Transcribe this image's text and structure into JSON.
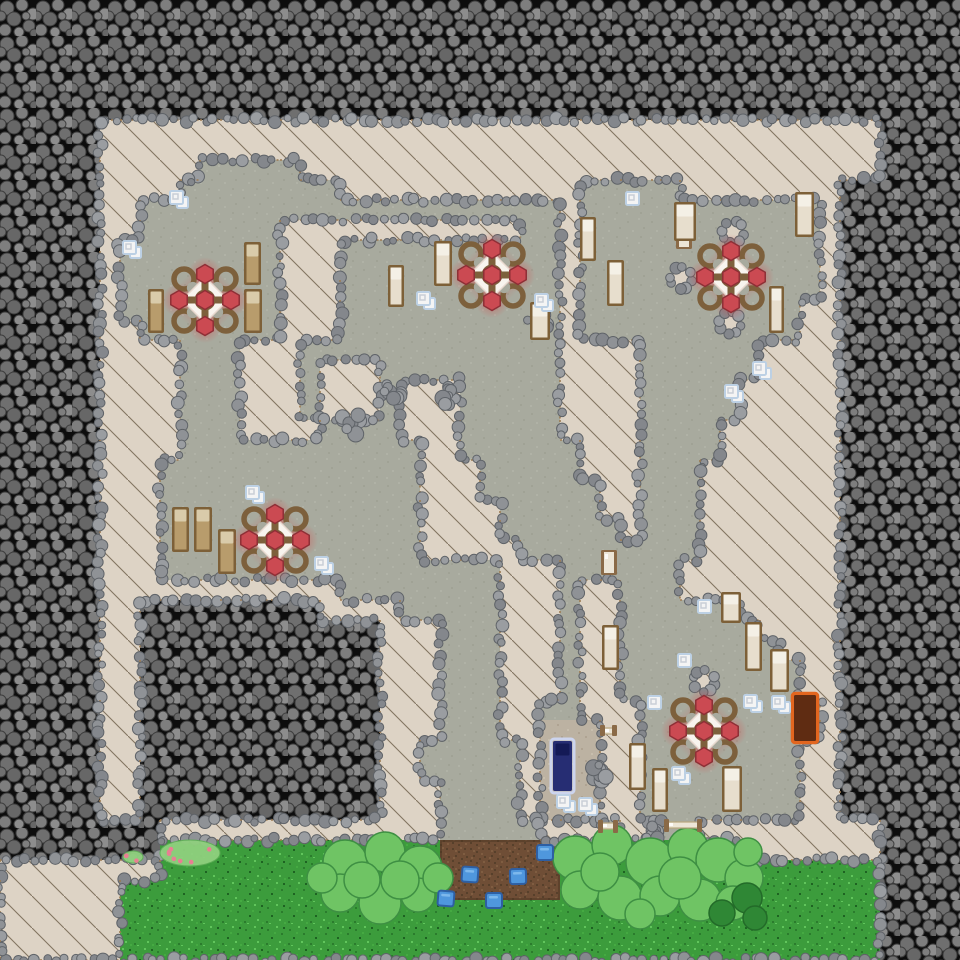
{
  "meta": {
    "width": 960,
    "height": 960,
    "tile_size": 20
  },
  "palette": {
    "rock_bg": "#0d0d0d",
    "boulder_fills": [
      "#6f6f6f",
      "#7e7e7e",
      "#8d8d8d",
      "#676767"
    ],
    "boulder_stroke": "#3d3d3d",
    "wall": "#ddd3c5",
    "wall_hatch": "#64543f",
    "wall_edge": "#9c7b52",
    "floor": "#a8aa9e",
    "floor_specks": [
      "#9da092",
      "#b2b4a7"
    ],
    "floor_light": "#bcb2a2",
    "floor_light_specks": [
      "#ab9f8e",
      "#c9c0b0"
    ],
    "grass": "#3c9c3c",
    "grass_speckles": [
      "#2b7c2d",
      "#61c55c",
      "#1e6322",
      "#45aa42"
    ],
    "dirt": "#6f4e36",
    "dirt_dots": [
      "#57402b",
      "#7f5d41"
    ],
    "dirt_edge": "#4e3723",
    "border_boulder": [
      "#8f9296",
      "#9a9da1",
      "#84878c"
    ],
    "border_boulder_stroke": "#5f6368",
    "glow_red": "#d64545",
    "table_wood": "#7d603c",
    "table_plate": "#f8f4ee",
    "table_plate_edge": "#e8d9cf",
    "table_food": "#cb4a52",
    "table_food_stroke": "#8e2f36",
    "bed_frame": "#7d6038",
    "bed_fill_light": "#e7decd",
    "bed_pillow_light": "#f4f0e6",
    "bed_fill_dark": "#b89c6c",
    "bed_pillow_dark": "#d9cbaa",
    "bed_blue_halo": "#cdd7f6",
    "bed_blue_fill": "#262d73",
    "bed_blue_dark": "#141a56",
    "bed_orange_halo": "#e2661f",
    "bed_orange_fill": "#5f2c12",
    "item_fill": "#f4f4f4",
    "item_stroke": "#bcd0e4",
    "door_wood": "#8a6a47",
    "door_panel": "#ece5d6",
    "bush_fill": "#6fc464",
    "bush_stroke": "#3e8f43",
    "bush_dark_fill": "#2f8735",
    "bush_dark_stroke": "#236b29",
    "flower_leaf": "#8fd07e",
    "flower_leaf_edge": "#5fae57",
    "flower_pink": "#e87f93",
    "crop_fill": "#4f97dd",
    "crop_stroke": "#2e5fa3",
    "crop_light": "#7db8ec"
  },
  "terrain": {
    "legend": {
      "#": "rock",
      "W": "wall-hatched",
      ".": "floor",
      "L": "floor-light",
      "G": "grass",
      "D": "tilled-dirt"
    },
    "grid": [
      "################################################",
      "################################################",
      "################################################",
      "################################################",
      "################################################",
      "################################################",
      "#####WWWWWWWWWWWWWWWWWWWWWWWWWWWWWWWWWWWWWWW####",
      "#####WWWWWWWWWWWWWWWWWWWWWWWWWWWWWWWWWWWWWWW####",
      "#####WWWWW.....WWWWWWWWWWWWWWWWWWWWWWWWWWWWW####",
      "#####WWWW........WWWWWWWWWWWW.....WWWWWWWW######",
      "#####WW.....................W............W######",
      "#####WW.......WWWWWWWWWWWW..W............W######",
      "#####W........WWW...........W............W######",
      "#####W........WWW...........W............W######",
      "#####W........WWW...........W............W######",
      "#####W........WWW...........W...........WW######",
      "#####WW.......WWW...........W...........WW######",
      "#####WWWW...WWW.............WWWW......WWWW######",
      "#####WWWW...WWW.WWW.........WWWW......WWWW######",
      "#####WWWW...WWW.WWW.WWW.....WWWW.....WWWWW######",
      "#####WWWW...WWW.WWW.WWW.....WWWW.....WWWWW######",
      "#####WWWW...WWWW....WWW.....WWWW....WWWWWW######",
      "#####WWWW............WW......WWW....WWWWWW######",
      "#####WWW.............WWW.....WWW...WWWWWWW######",
      "#####WWW.............WWW......WW...WWWWWWW######",
      "#####WWW.............WWWW.....WW...WWWWWWW######",
      "#####WWW.............WWWW......W...WWWWWWW######",
      "#####WWW.............WWWWW.........WWWWWWW######",
      "#####WWW.................WWW......WWWWWWWW######",
      "#####WWWWWWWWWWWW........WWW.WW...WWWWWWWW######",
      "#####WW#########WWWW.....WWW.WW......WWWWW######",
      "#####WW############WWW...WWW.WW.......WWWW######",
      "#####WW############WWW...WWW.WW........WWW######",
      "#####WW############WWW...WWW.WW.........WW######",
      "#####WW############WWW...WWW.WW.........WW######",
      "#####WW############WWW...WW..WWW.........W######",
      "#####WW############WWW...WWLLLWW.........W######",
      "#####WW############WW.....WLLLWW........WW######",
      "#####WW############WW.....WLLLWW........WW######",
      "#####WW############WWW....WLLLWW........WW######",
      "#####WW############WWW....WLLLWW........WW######",
      "########WWWWWWWWWWWWWW.....WWW.WW..WWWWWWWWW####",
      "########GGGGGGGGGGGGGGDDDDDDGGGGGGGGGWWWWWWW####",
      "WWWWWWWWGGGGGGGGGGGGGGDDDDDDGGGGGGGGGGGGGGGG####",
      "WWWWWWGGGGGGGGGGGGGGGGDDDDDDGGGGGGGGGGGGGGGG####",
      "WWWWWWGGGGGGGGGGGGGGGGGGGGGGGGGGGGGGGGGGGGGG####",
      "WWWWWWGGGGGGGGGGGGGGGGGGGGGGGGGGGGGGGGGGGGGG####",
      "WWWWWWGGGGGGGGGGGGGGGGGGGGGGGGGGGGGGGGGGGGGG####"
    ]
  },
  "sprites": {
    "tables": [
      [
        205,
        300
      ],
      [
        492,
        275
      ],
      [
        731,
        277
      ],
      [
        275,
        540
      ],
      [
        704,
        731
      ]
    ],
    "beds": [
      [
        244,
        242,
        17,
        43,
        "dark"
      ],
      [
        244,
        289,
        18,
        44,
        "dark"
      ],
      [
        148,
        289,
        16,
        44,
        "dark"
      ],
      [
        434,
        241,
        18,
        45,
        "light"
      ],
      [
        388,
        265,
        16,
        42,
        "light"
      ],
      [
        530,
        302,
        20,
        38,
        "light"
      ],
      [
        580,
        217,
        16,
        44,
        "light"
      ],
      [
        607,
        260,
        17,
        46,
        "light"
      ],
      [
        674,
        202,
        22,
        39,
        "light"
      ],
      [
        769,
        286,
        15,
        47,
        "light"
      ],
      [
        795,
        192,
        19,
        45,
        "light"
      ],
      [
        172,
        507,
        17,
        45,
        "dark"
      ],
      [
        194,
        507,
        18,
        45,
        "dark"
      ],
      [
        218,
        529,
        18,
        45,
        "dark"
      ],
      [
        602,
        625,
        17,
        45,
        "light"
      ],
      [
        721,
        592,
        20,
        31,
        "light"
      ],
      [
        745,
        622,
        17,
        49,
        "light"
      ],
      [
        770,
        649,
        19,
        43,
        "light"
      ],
      [
        629,
        743,
        17,
        47,
        "light"
      ],
      [
        652,
        768,
        16,
        44,
        "light"
      ],
      [
        722,
        766,
        20,
        46,
        "light"
      ]
    ],
    "special_beds": [
      {
        "x": 553,
        "y": 741,
        "w": 19,
        "h": 50,
        "type": "blue"
      },
      {
        "x": 794,
        "y": 695,
        "w": 22,
        "h": 46,
        "type": "orange"
      }
    ],
    "doors": [
      {
        "x": 601,
        "y": 550,
        "w": 16,
        "h": 25,
        "o": "v"
      },
      {
        "x": 676,
        "y": 210,
        "w": 16,
        "h": 39,
        "o": "v"
      },
      {
        "x": 600,
        "y": 820,
        "w": 16,
        "h": 13,
        "o": "h"
      },
      {
        "x": 666,
        "y": 819,
        "w": 34,
        "h": 13,
        "o": "h"
      },
      {
        "x": 602,
        "y": 725,
        "w": 13,
        "h": 11,
        "o": "h"
      }
    ],
    "item_piles": [
      [
        170,
        191,
        2
      ],
      [
        123,
        241,
        2
      ],
      [
        417,
        292,
        2
      ],
      [
        535,
        294,
        2
      ],
      [
        626,
        192,
        1
      ],
      [
        753,
        362,
        2
      ],
      [
        725,
        385,
        2
      ],
      [
        246,
        486,
        2
      ],
      [
        315,
        557,
        2
      ],
      [
        698,
        600,
        1
      ],
      [
        678,
        654,
        1
      ],
      [
        648,
        696,
        1
      ],
      [
        744,
        695,
        2
      ],
      [
        772,
        696,
        2
      ],
      [
        672,
        767,
        2
      ],
      [
        557,
        795,
        2
      ],
      [
        579,
        798,
        2
      ]
    ],
    "pillars": [
      [
        733,
        232
      ],
      [
        681,
        278
      ],
      [
        730,
        323
      ],
      [
        704,
        681
      ]
    ],
    "rubble": [
      [
        390,
        392
      ],
      [
        449,
        394
      ],
      [
        352,
        424
      ],
      [
        538,
        320
      ],
      [
        598,
        772
      ],
      [
        648,
        834
      ]
    ],
    "bushes": [
      {
        "circles": [
          [
            345,
            862,
            22
          ],
          [
            385,
            852,
            20
          ],
          [
            420,
            868,
            22
          ],
          [
            340,
            893,
            19
          ],
          [
            380,
            903,
            21
          ],
          [
            418,
            895,
            17
          ],
          [
            438,
            878,
            15
          ],
          [
            322,
            878,
            15
          ],
          [
            362,
            880,
            18
          ],
          [
            400,
            880,
            19
          ]
        ],
        "dark": []
      },
      {
        "circles": [
          [
            575,
            858,
            22
          ],
          [
            612,
            845,
            20
          ],
          [
            650,
            862,
            24
          ],
          [
            688,
            848,
            20
          ],
          [
            718,
            860,
            22
          ],
          [
            744,
            878,
            19
          ],
          [
            580,
            890,
            19
          ],
          [
            620,
            898,
            22
          ],
          [
            660,
            896,
            20
          ],
          [
            700,
            900,
            21
          ],
          [
            733,
            903,
            17
          ],
          [
            600,
            872,
            19
          ],
          [
            680,
            878,
            21
          ],
          [
            640,
            914,
            15
          ],
          [
            748,
            852,
            14
          ]
        ],
        "dark": [
          [
            747,
            898,
            15
          ],
          [
            722,
            913,
            13
          ],
          [
            755,
            918,
            12
          ]
        ]
      }
    ],
    "flowers": [
      {
        "x": 190,
        "y": 853,
        "rx": 30,
        "ry": 13
      },
      {
        "x": 133,
        "y": 857,
        "rx": 10,
        "ry": 6
      }
    ],
    "crops": [
      [
        537,
        845
      ],
      [
        462,
        867
      ],
      [
        510,
        869
      ],
      [
        438,
        891
      ],
      [
        486,
        893
      ]
    ]
  }
}
